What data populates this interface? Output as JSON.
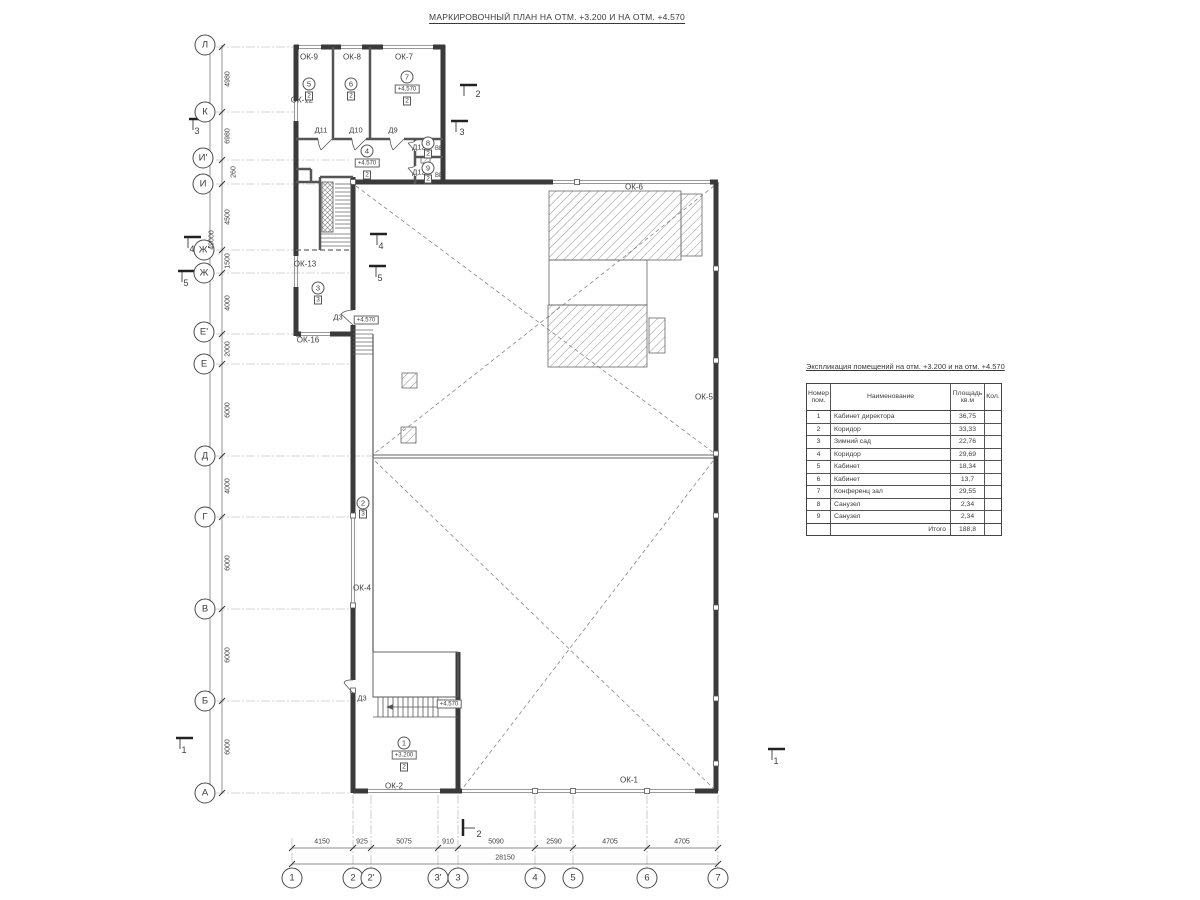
{
  "title": "МАРКИРОВОЧНЫЙ ПЛАН НА ОТМ. +3.200 И НА ОТМ. +4.570",
  "explication": {
    "title": "Экспликация помещений на отм. +3.200 и на отм. +4.570",
    "columns": [
      "Номер пом.",
      "Наименование",
      "Площадь кв.м",
      "Кол."
    ],
    "rows": [
      {
        "num": "1",
        "name": "Кабинет директора",
        "area": "36,75",
        "qty": ""
      },
      {
        "num": "2",
        "name": "Коридор",
        "area": "33,33",
        "qty": ""
      },
      {
        "num": "3",
        "name": "Зимний сад",
        "area": "22,76",
        "qty": ""
      },
      {
        "num": "4",
        "name": "Коридор",
        "area": "29,69",
        "qty": ""
      },
      {
        "num": "5",
        "name": "Кабинет",
        "area": "18,34",
        "qty": ""
      },
      {
        "num": "6",
        "name": "Кабинет",
        "area": "13,7",
        "qty": ""
      },
      {
        "num": "7",
        "name": "Конференц зал",
        "area": "29,55",
        "qty": ""
      },
      {
        "num": "8",
        "name": "Санузел",
        "area": "2,34",
        "qty": ""
      },
      {
        "num": "9",
        "name": "Санузел",
        "area": "2,34",
        "qty": ""
      }
    ],
    "total": {
      "label": "Итого",
      "area": "188,8"
    }
  },
  "plan": {
    "labels": [
      {
        "t": "axis",
        "n": "axis-row-Л",
        "text": "Л",
        "x": 205,
        "y": 45
      },
      {
        "t": "axis",
        "n": "axis-row-К",
        "text": "К",
        "x": 205,
        "y": 112
      },
      {
        "t": "axis",
        "n": "axis-row-И1",
        "text": "И'",
        "x": 203,
        "y": 158
      },
      {
        "t": "axis",
        "n": "axis-row-И",
        "text": "И",
        "x": 203,
        "y": 184
      },
      {
        "t": "axis",
        "n": "axis-row-Ж1",
        "text": "Ж'",
        "x": 204,
        "y": 250
      },
      {
        "t": "axis",
        "n": "axis-row-Ж",
        "text": "Ж",
        "x": 204,
        "y": 273
      },
      {
        "t": "axis",
        "n": "axis-row-Е1",
        "text": "Е'",
        "x": 204,
        "y": 332
      },
      {
        "t": "axis",
        "n": "axis-row-Е",
        "text": "Е",
        "x": 204,
        "y": 364
      },
      {
        "t": "axis",
        "n": "axis-row-Д",
        "text": "Д",
        "x": 205,
        "y": 456
      },
      {
        "t": "axis",
        "n": "axis-row-Г",
        "text": "Г",
        "x": 205,
        "y": 517
      },
      {
        "t": "axis",
        "n": "axis-row-В",
        "text": "В",
        "x": 205,
        "y": 609
      },
      {
        "t": "axis",
        "n": "axis-row-Б",
        "text": "Б",
        "x": 205,
        "y": 701
      },
      {
        "t": "axis",
        "n": "axis-row-А",
        "text": "А",
        "x": 205,
        "y": 793
      },
      {
        "t": "axis",
        "n": "axis-col-1",
        "text": "1",
        "x": 292,
        "y": 878
      },
      {
        "t": "axis",
        "n": "axis-col-2",
        "text": "2",
        "x": 353,
        "y": 878
      },
      {
        "t": "axis",
        "n": "axis-col-2a",
        "text": "2'",
        "x": 371,
        "y": 878
      },
      {
        "t": "axis",
        "n": "axis-col-3a",
        "text": "3'",
        "x": 438,
        "y": 878
      },
      {
        "t": "axis",
        "n": "axis-col-3",
        "text": "3",
        "x": 458,
        "y": 878
      },
      {
        "t": "axis",
        "n": "axis-col-4",
        "text": "4",
        "x": 535,
        "y": 878
      },
      {
        "t": "axis",
        "n": "axis-col-5",
        "text": "5",
        "x": 573,
        "y": 878
      },
      {
        "t": "axis",
        "n": "axis-col-6",
        "text": "6",
        "x": 647,
        "y": 878
      },
      {
        "t": "axis",
        "n": "axis-col-7",
        "text": "7",
        "x": 718,
        "y": 878
      },
      {
        "t": "dimv",
        "n": "dim-left",
        "text": "4980",
        "x": 228,
        "y": 79
      },
      {
        "t": "dimv",
        "n": "dim-left",
        "text": "6980",
        "x": 228,
        "y": 136
      },
      {
        "t": "dimv",
        "n": "dim-left",
        "text": "260",
        "x": 234,
        "y": 172
      },
      {
        "t": "dimv",
        "n": "dim-left",
        "text": "4500",
        "x": 228,
        "y": 217
      },
      {
        "t": "dimv",
        "n": "dim-left",
        "text": "1500",
        "x": 228,
        "y": 261
      },
      {
        "t": "dimv",
        "n": "dim-left",
        "text": "4000",
        "x": 228,
        "y": 303
      },
      {
        "t": "dimv",
        "n": "dim-left",
        "text": "2000",
        "x": 228,
        "y": 349
      },
      {
        "t": "dimv",
        "n": "dim-left",
        "text": "6000",
        "x": 228,
        "y": 410
      },
      {
        "t": "dimv",
        "n": "dim-left",
        "text": "4000",
        "x": 228,
        "y": 486
      },
      {
        "t": "dimv",
        "n": "dim-left",
        "text": "6000",
        "x": 228,
        "y": 563
      },
      {
        "t": "dimv",
        "n": "dim-left",
        "text": "6000",
        "x": 228,
        "y": 655
      },
      {
        "t": "dimv",
        "n": "dim-left",
        "text": "6000",
        "x": 228,
        "y": 747
      },
      {
        "t": "dimv",
        "n": "dim-left-total",
        "text": "49000",
        "x": 212,
        "y": 240
      },
      {
        "t": "dimh",
        "n": "dim-bottom",
        "text": "4150",
        "x": 322,
        "y": 842
      },
      {
        "t": "dimh",
        "n": "dim-bottom",
        "text": "925",
        "x": 362,
        "y": 842
      },
      {
        "t": "dimh",
        "n": "dim-bottom",
        "text": "5075",
        "x": 404,
        "y": 842
      },
      {
        "t": "dimh",
        "n": "dim-bottom",
        "text": "910",
        "x": 448,
        "y": 842
      },
      {
        "t": "dimh",
        "n": "dim-bottom",
        "text": "5090",
        "x": 496,
        "y": 842
      },
      {
        "t": "dimh",
        "n": "dim-bottom",
        "text": "2590",
        "x": 554,
        "y": 842
      },
      {
        "t": "dimh",
        "n": "dim-bottom",
        "text": "4705",
        "x": 610,
        "y": 842
      },
      {
        "t": "dimh",
        "n": "dim-bottom",
        "text": "4705",
        "x": 682,
        "y": 842
      },
      {
        "t": "dimh",
        "n": "dim-bottom-total",
        "text": "28150",
        "x": 505,
        "y": 858
      },
      {
        "t": "plabel",
        "n": "window-label-ОК-9",
        "text": "ОК-9",
        "x": 309,
        "y": 57
      },
      {
        "t": "plabel",
        "n": "window-label-ОК-8",
        "text": "ОК-8",
        "x": 352,
        "y": 57
      },
      {
        "t": "plabel",
        "n": "window-label-ОК-7",
        "text": "ОК-7",
        "x": 404,
        "y": 57
      },
      {
        "t": "plabel",
        "n": "window-label-ОК-12",
        "text": "ОК-12",
        "x": 302,
        "y": 100
      },
      {
        "t": "plabel",
        "n": "window-label-ОК-13",
        "text": "ОК-13",
        "x": 305,
        "y": 264
      },
      {
        "t": "plabel",
        "n": "window-label-ОК-16",
        "text": "ОК-16",
        "x": 308,
        "y": 340
      },
      {
        "t": "plabel",
        "n": "window-label-ОК-6",
        "text": "ОК-6",
        "x": 634,
        "y": 187
      },
      {
        "t": "plabel",
        "n": "window-label-ОК-5",
        "text": "ОК-5",
        "x": 704,
        "y": 397
      },
      {
        "t": "plabel",
        "n": "window-label-ОК-4",
        "text": "ОК-4",
        "x": 362,
        "y": 588
      },
      {
        "t": "plabel",
        "n": "window-label-ОК-2",
        "text": "ОК-2",
        "x": 394,
        "y": 786
      },
      {
        "t": "plabel",
        "n": "window-label-ОК-1",
        "text": "ОК-1",
        "x": 629,
        "y": 780
      },
      {
        "t": "dlabel",
        "n": "door-label-Д11",
        "text": "Д11",
        "x": 321,
        "y": 130
      },
      {
        "t": "dlabel",
        "n": "door-label-Д10",
        "text": "Д10",
        "x": 356,
        "y": 130
      },
      {
        "t": "dlabel",
        "n": "door-label-Д9",
        "text": "Д9",
        "x": 393,
        "y": 130
      },
      {
        "t": "dlabel",
        "n": "door-label-Д12",
        "text": "Д12",
        "x": 419,
        "y": 147
      },
      {
        "t": "dlabel",
        "n": "door-label-Д12",
        "text": "Д12",
        "x": 419,
        "y": 172
      },
      {
        "t": "dlabel",
        "n": "door-label-Д3",
        "text": "Д3",
        "x": 338,
        "y": 317
      },
      {
        "t": "dlabel",
        "n": "door-label-Д3",
        "text": "Д3",
        "x": 362,
        "y": 698
      },
      {
        "t": "roomc",
        "n": "room-number-5",
        "text": "5",
        "x": 309,
        "y": 84
      },
      {
        "t": "roombox",
        "n": "room-type-5",
        "text": "2",
        "x": 309,
        "y": 96
      },
      {
        "t": "roomc",
        "n": "room-number-6",
        "text": "6",
        "x": 351,
        "y": 84
      },
      {
        "t": "roombox",
        "n": "room-type-6",
        "text": "2",
        "x": 351,
        "y": 96
      },
      {
        "t": "roomc",
        "n": "room-number-7",
        "text": "7",
        "x": 407,
        "y": 77
      },
      {
        "t": "elev",
        "n": "elevation-mark",
        "text": "+4.570",
        "x": 407,
        "y": 89
      },
      {
        "t": "roombox",
        "n": "room-type-7",
        "text": "2",
        "x": 407,
        "y": 101
      },
      {
        "t": "roomc",
        "n": "room-number-4",
        "text": "4",
        "x": 367,
        "y": 151
      },
      {
        "t": "elev",
        "n": "elevation-mark",
        "text": "+4.570",
        "x": 367,
        "y": 163
      },
      {
        "t": "roombox",
        "n": "room-type-4",
        "text": "2",
        "x": 367,
        "y": 175
      },
      {
        "t": "roomc",
        "n": "room-number-8",
        "text": "8",
        "x": 428,
        "y": 143
      },
      {
        "t": "roombox",
        "n": "room-type-8",
        "text": "2",
        "x": 428,
        "y": 154
      },
      {
        "t": "roomc",
        "n": "room-number-9",
        "text": "9",
        "x": 428,
        "y": 168
      },
      {
        "t": "roombox",
        "n": "room-type-9",
        "text": "2",
        "x": 428,
        "y": 179
      },
      {
        "t": "roomc",
        "n": "room-number-3",
        "text": "3",
        "x": 318,
        "y": 288
      },
      {
        "t": "roombox",
        "n": "room-type-3",
        "text": "3",
        "x": 318,
        "y": 300
      },
      {
        "t": "roomc",
        "n": "room-number-2",
        "text": "2",
        "x": 363,
        "y": 503
      },
      {
        "t": "roombox",
        "n": "room-type-2",
        "text": "3",
        "x": 363,
        "y": 514
      },
      {
        "t": "roomc",
        "n": "room-number-1",
        "text": "1",
        "x": 404,
        "y": 743
      },
      {
        "t": "elev",
        "n": "elevation-mark",
        "text": "+3.200",
        "x": 404,
        "y": 755
      },
      {
        "t": "roombox",
        "n": "room-type-1",
        "text": "2",
        "x": 404,
        "y": 767
      },
      {
        "t": "elev",
        "n": "elevation-mark-stair",
        "text": "+4.570",
        "x": 449,
        "y": 704
      },
      {
        "t": "elev",
        "n": "elevation-mark",
        "text": "+4.570",
        "x": 366,
        "y": 320
      },
      {
        "t": "tiny",
        "n": "vent-block-label",
        "text": "ВБ",
        "x": 439,
        "y": 149
      },
      {
        "t": "tiny",
        "n": "vent-block-label",
        "text": "ВБ",
        "x": 439,
        "y": 176
      },
      {
        "t": "sec",
        "n": "section-mark-3",
        "text": "3",
        "x": 197,
        "y": 131
      },
      {
        "t": "sec",
        "n": "section-mark-3",
        "text": "3",
        "x": 462,
        "y": 132
      },
      {
        "t": "sec",
        "n": "section-mark-2",
        "text": "2",
        "x": 478,
        "y": 94
      },
      {
        "t": "sec",
        "n": "section-mark-2",
        "text": "2",
        "x": 479,
        "y": 834
      },
      {
        "t": "sec",
        "n": "section-mark-4",
        "text": "4",
        "x": 192,
        "y": 249
      },
      {
        "t": "sec",
        "n": "section-mark-5",
        "text": "5",
        "x": 186,
        "y": 283
      },
      {
        "t": "sec",
        "n": "section-mark-4",
        "text": "4",
        "x": 381,
        "y": 246
      },
      {
        "t": "sec",
        "n": "section-mark-5",
        "text": "5",
        "x": 380,
        "y": 278
      },
      {
        "t": "sec",
        "n": "section-mark-1",
        "text": "1",
        "x": 184,
        "y": 750
      },
      {
        "t": "sec",
        "n": "section-mark-1",
        "text": "1",
        "x": 776,
        "y": 761
      }
    ]
  }
}
